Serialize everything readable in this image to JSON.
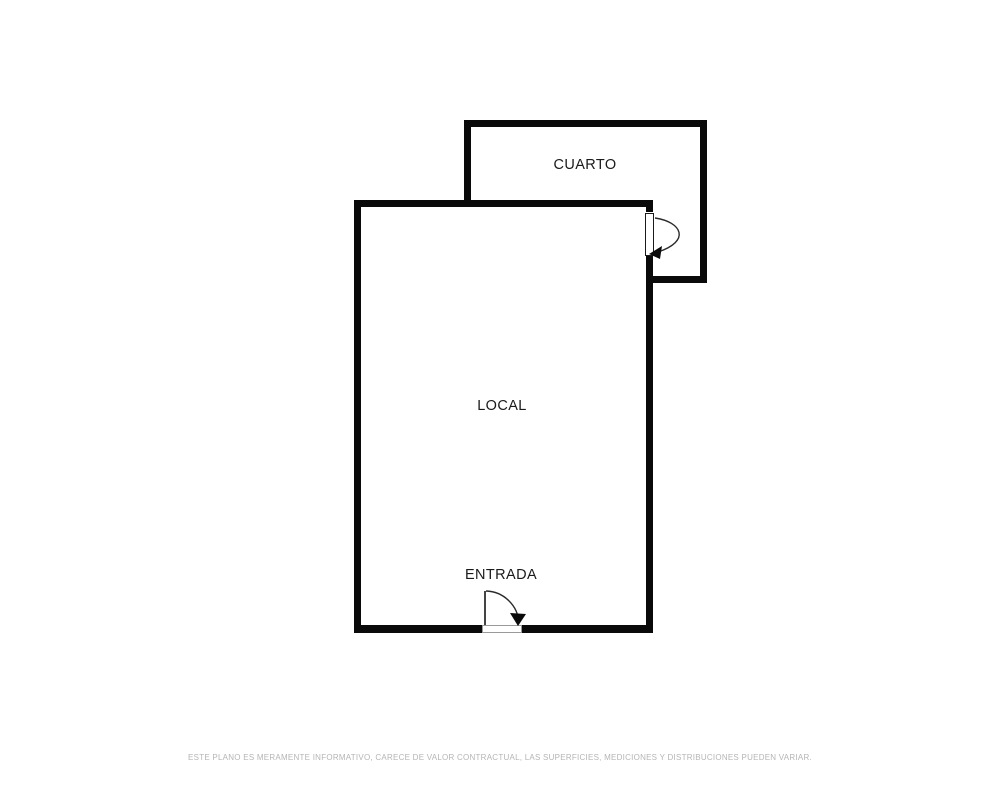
{
  "plan": {
    "rooms": {
      "cuarto": {
        "label": "CUARTO"
      },
      "local": {
        "label": "LOCAL"
      }
    },
    "entrance": {
      "label": "ENTRADA"
    },
    "disclaimer": "ESTE PLANO ES MERAMENTE INFORMATIVO, CARECE DE VALOR CONTRACTUAL, LAS SUPERFICIES, MEDICIONES Y DISTRIBUCIONES PUEDEN VARIAR.",
    "colors": {
      "wall": "#0a0a0a",
      "label": "#1a1a1a",
      "disclaimer": "#b5b5b5",
      "background": "#ffffff",
      "door_line": "#2b2b2b"
    }
  }
}
